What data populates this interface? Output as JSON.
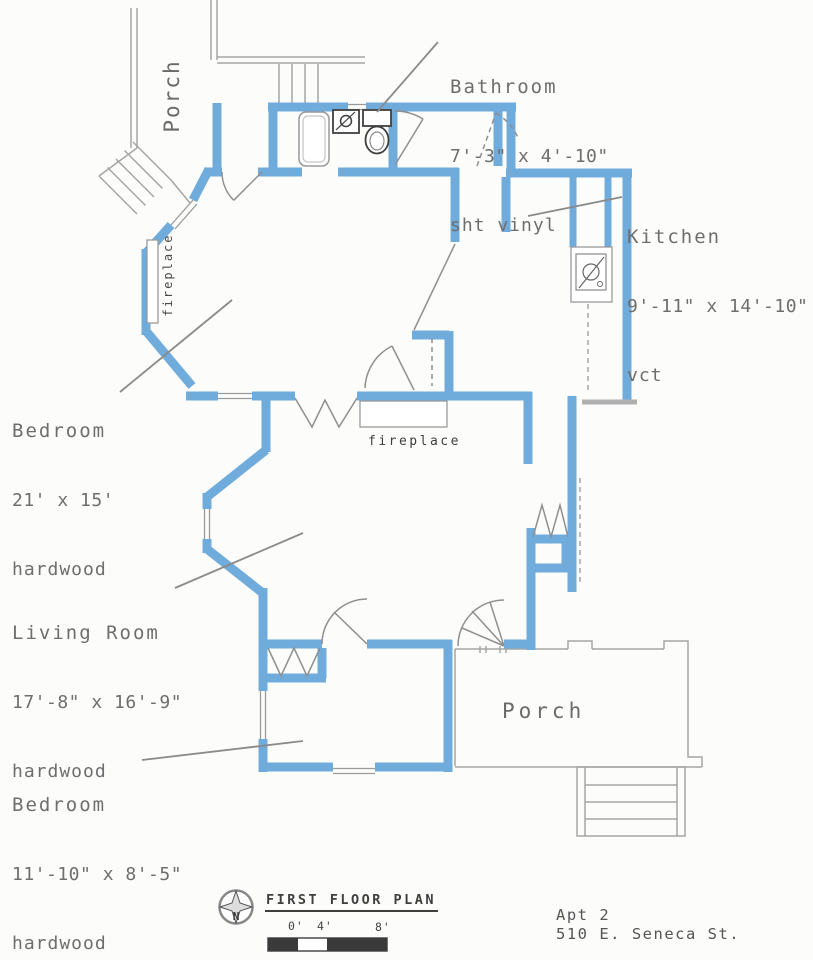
{
  "plan": {
    "labels": {
      "bathroom": {
        "name": "Bathroom",
        "dims": "7'-3\" x 4'-10\"",
        "floor": "sht vinyl"
      },
      "kitchen": {
        "name": "Kitchen",
        "dims": "9'-11\" x 14'-10\"",
        "floor": "vct"
      },
      "bedroom_large": {
        "name": "Bedroom",
        "dims": "21' x 15'",
        "floor": "hardwood"
      },
      "living_room": {
        "name": "Living Room",
        "dims": "17'-8\" x 16'-9\"",
        "floor": "hardwood"
      },
      "bedroom_small": {
        "name": "Bedroom",
        "dims": "11'-10\" x 8'-5\"",
        "floor": "hardwood"
      },
      "porch_upper": "Porch",
      "porch_lower": "Porch",
      "fireplace_bedroom": "fireplace",
      "fireplace_living": "fireplace"
    },
    "title_block": {
      "title": "FIRST FLOOR PLAN",
      "north_label": "N",
      "ticks": [
        "0'",
        "4'",
        "8'"
      ],
      "apartment": "Apt 2",
      "address": "510 E. Seneca St."
    },
    "colors": {
      "wall_blue": "#6FABDB",
      "line_gray": "#9a9a9a",
      "text_gray": "#6e6e6e",
      "dark": "#3a3a3a"
    }
  }
}
